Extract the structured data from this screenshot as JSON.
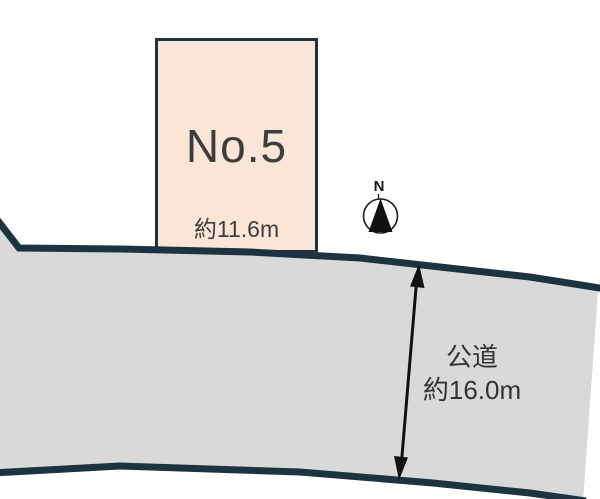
{
  "diagram": {
    "plot": {
      "label": "No.5",
      "frontage": "約11.6m"
    },
    "road": {
      "name": "公道",
      "width": "約16.0m"
    },
    "compass": {
      "label": "N"
    },
    "colors": {
      "plot_fill": "#fbe5d6",
      "outline_navy": "#1d3440",
      "road_fill": "#d9d9d9",
      "text_dark": "#3d3d3d",
      "arrow_black": "#111111"
    }
  }
}
